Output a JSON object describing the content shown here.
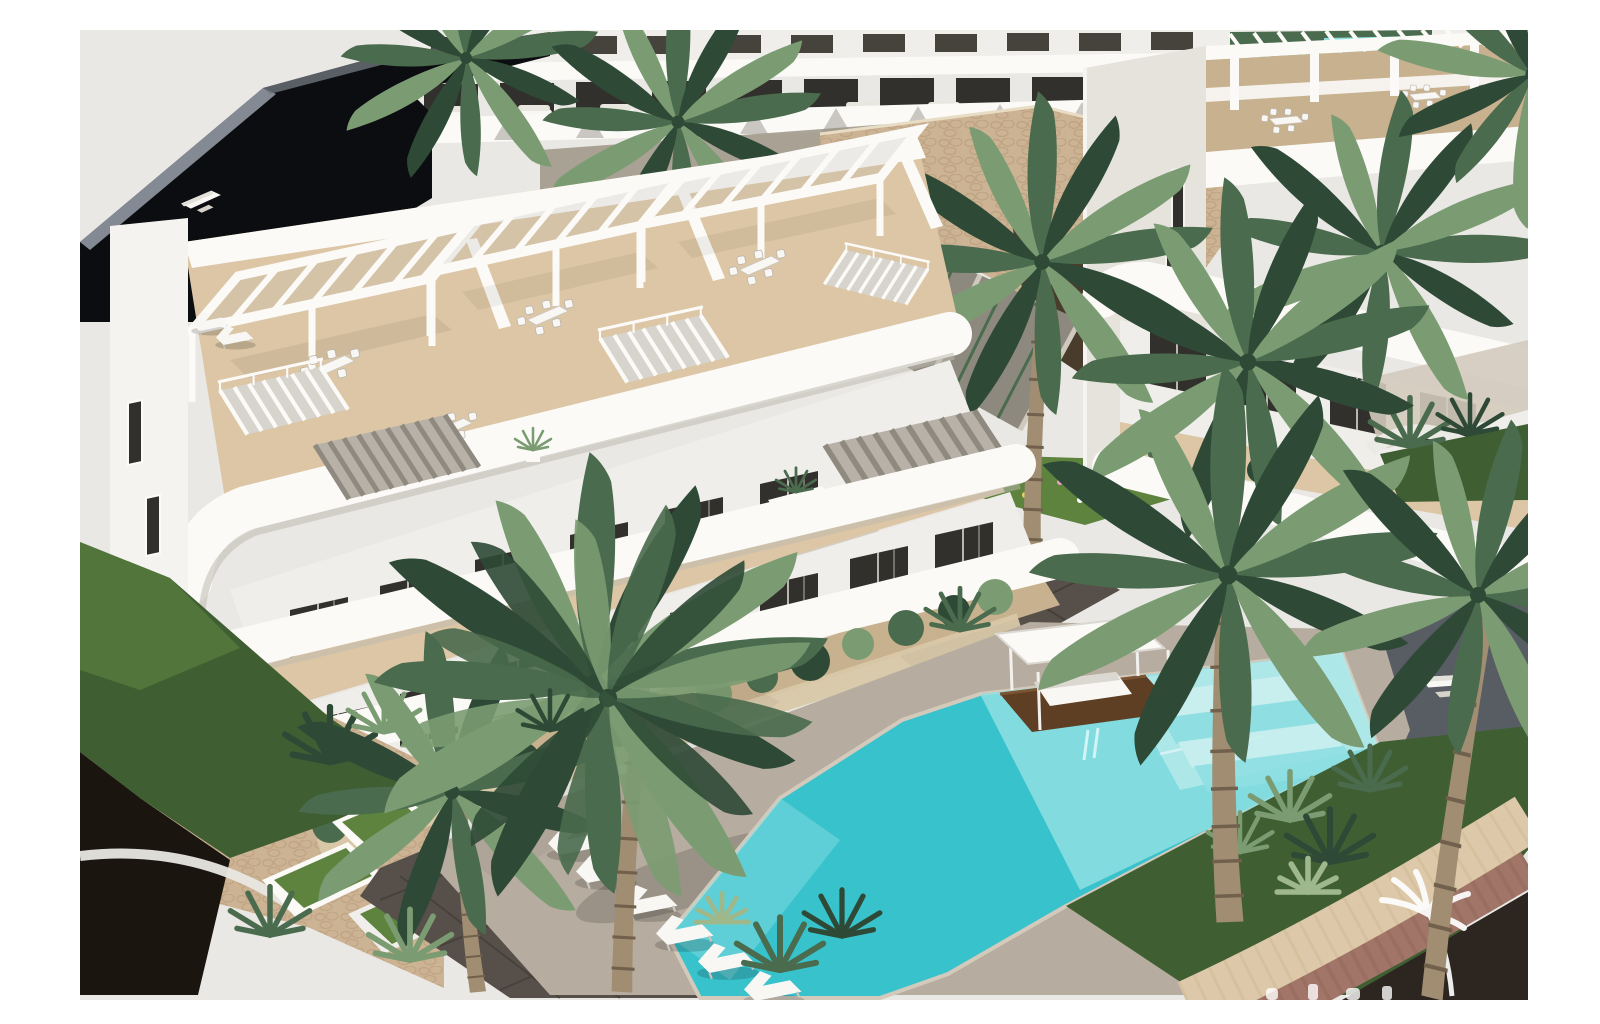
{
  "meta": {
    "type": "architectural-3d-render",
    "description": "Aerial 3D visualisation of a modern white hillside apartment complex: rooftop terraces with slatted pergolas and dining sets, external white staircases, stone retaining walls, tropical landscaping with tall palm trees, a turquoise communal swimming pool with steps, a wooden platform with a white canopy daybed, white sun loungers on a pale deck, white sculpted garden planters and a curved road with stone kerb in the lower-right corner."
  },
  "colors": {
    "sky": "#eae8e5",
    "dark_roof": "#0c0d10",
    "roof_edge": "#9aa1ab",
    "white_bright": "#fbfaf7",
    "white_face": "#efeeea",
    "white_shade": "#dbd8d2",
    "white_deep": "#c2beb6",
    "glass": "#32302c",
    "glass_light": "#46433c",
    "terrace_floor": "#dcc6a5",
    "terrace_floor_shade": "#c8b18e",
    "stone_light": "#ccb394",
    "stone_mid": "#b29774",
    "stone_dark": "#4a3c2d",
    "green_dark": "#2e4a36",
    "green_mid": "#4a6b4d",
    "green_light": "#7b9c72",
    "green_grass": "#3f5f33",
    "green_grass_light": "#5d833f",
    "trunk": "#a08d72",
    "trunk_shade": "#70604c",
    "pool": "#38c2cc",
    "pool_light": "#8fdfe2",
    "pool_pale": "#c9eeee",
    "deck": "#b6ac9f",
    "deck_light": "#d3cabc",
    "wood": "#5f3f23",
    "road": "#2c2520",
    "paver": "#a17668",
    "paver_dark": "#57504a",
    "stone_band": "#ddc9a9",
    "furniture_white": "#f8f7f4",
    "sand": "#d9c8a9",
    "garage": "#131110",
    "shadow_dark": "#1a150f"
  },
  "scene": {
    "main_building": {
      "floors_visible": 4,
      "rooftop_pergolas": 3,
      "external_staircases": 5,
      "garage_doors": 1
    },
    "right_building": {
      "rooftop_pergolas": 3,
      "slit_windows": 2
    },
    "background_building": {
      "terrace_units_visible": 9
    },
    "pool": {
      "water_color_name": "turquoise",
      "steps": 4,
      "wooden_platform": true,
      "canopy_daybed": true,
      "background_pool": true
    },
    "sun_loungers_poolside": 6,
    "roof_loungers": 2,
    "dining_sets": 6,
    "large_palm_trees": 9,
    "watermark": {
      "palm_logo": true,
      "text_cropped_at_bottom_edge": true
    }
  }
}
